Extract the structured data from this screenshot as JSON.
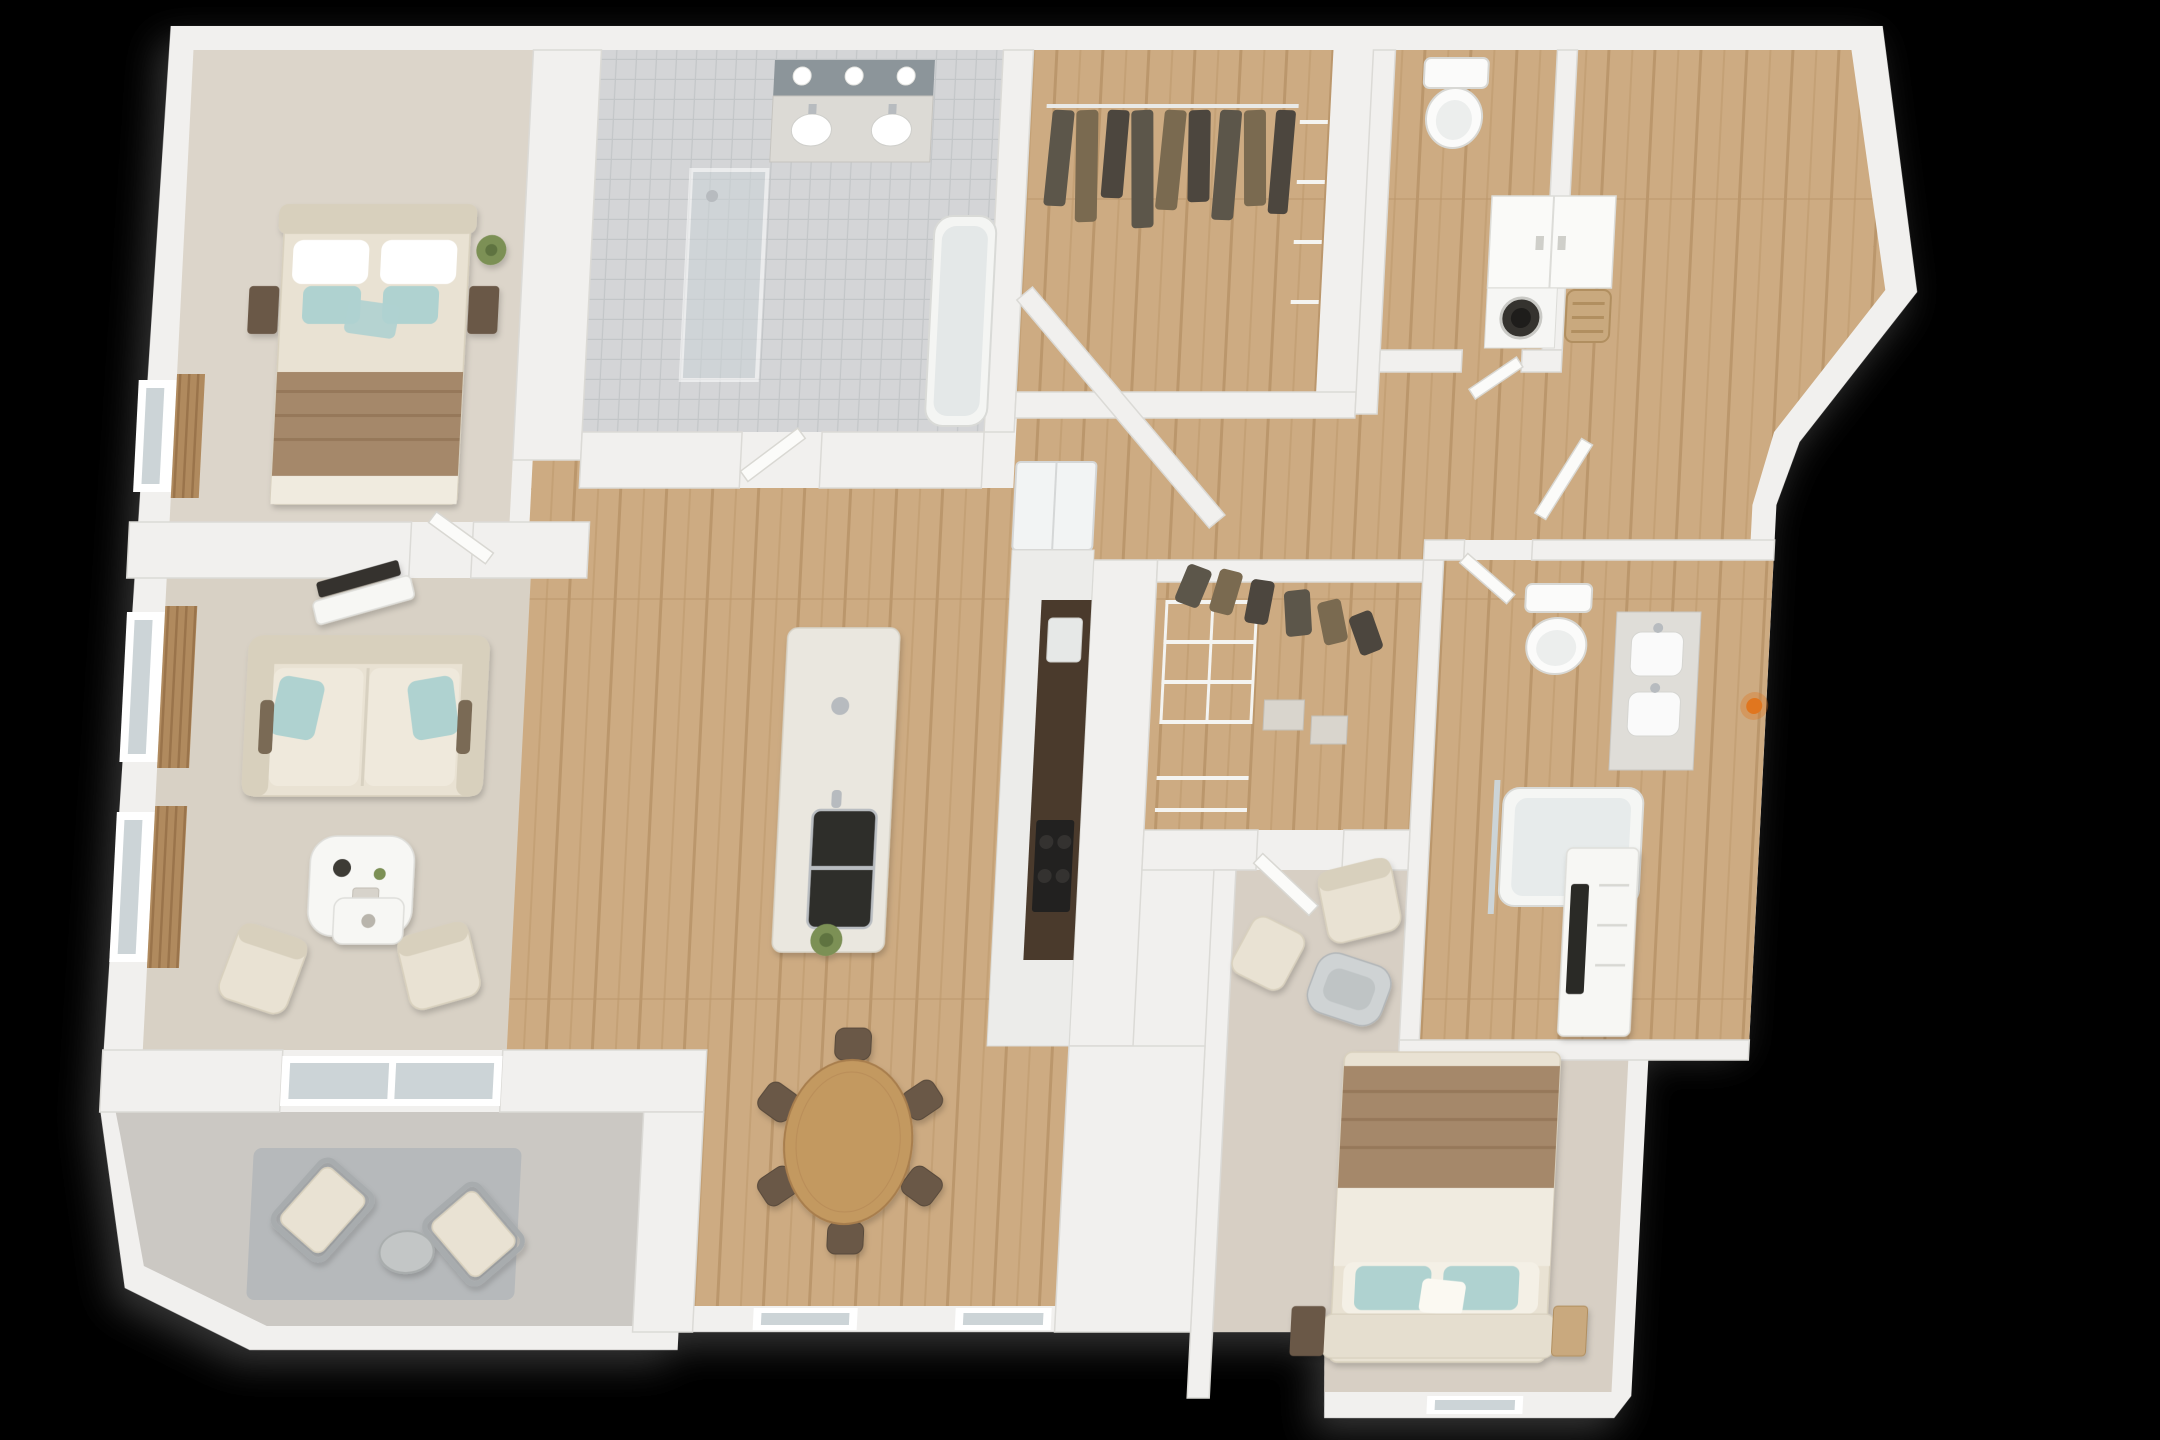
{
  "scene": {
    "description": "3D rendered top-down dollhouse floor plan of a two-bedroom two-bath apartment on a black background",
    "render_style": "3d-floor-plan-render",
    "visible_text": ""
  },
  "palette": {
    "bg": "#000000",
    "wall": "#f1f0ee",
    "wallEdge": "#dbdad6",
    "wood": "#cdab82",
    "woodDark": "#bb976c",
    "woodMid": "#c4a176",
    "tile": "#d4d5d7",
    "tileLine": "#c3c6c8",
    "carpet1": "#dcd5ca",
    "carpet2": "#d7cfc4",
    "rugLiving": "#d8d1c5",
    "rugPatio": "#b6b9bb",
    "patioFloor": "#cbc8c3",
    "cream": "#e9e2d3",
    "creamShade": "#d8d0bd",
    "teal": "#afd2d0",
    "blanket": "#a5886a",
    "darkwood": "#6b5847",
    "counter": "#4a3a2c",
    "appliance": "#222120",
    "olive": "#5c564a",
    "brown2": "#7a6a50",
    "plant": "#7b9055",
    "chrome": "#b7bbbf",
    "glass": "#ccd4d7",
    "mirror": "#8c959a",
    "tableWood": "#c39960",
    "orange": "#e0761f",
    "curtainA": "#b08a5e",
    "curtainB": "#9a744b"
  },
  "apartment": {
    "rooms": [
      {
        "id": "bedroom-1",
        "furniture": [
          "double-bed",
          "teal-pillows",
          "brown-throw-blanket",
          "nightstand-left",
          "nightstand-right",
          "plant",
          "window-with-curtain"
        ]
      },
      {
        "id": "living-room",
        "furniture": [
          "sofa",
          "teal-throw-pillows",
          "coffee-table",
          "tv-console",
          "armchair-left",
          "armchair-right",
          "side-table",
          "curtained-window-upper",
          "curtained-window-lower",
          "area-rug"
        ]
      },
      {
        "id": "patio",
        "furniture": [
          "lounge-chair-left",
          "lounge-chair-right",
          "outdoor-side-table",
          "outdoor-rug",
          "sliding-glass-door"
        ]
      },
      {
        "id": "dining-area",
        "furniture": [
          "round-wood-table",
          "dining-chairs-x6",
          "window-left",
          "window-right"
        ]
      },
      {
        "id": "kitchen",
        "furniture": [
          "island-with-sink-and-faucet",
          "island-plant",
          "refrigerator",
          "cabinet-run",
          "dark-counter-bar",
          "cooktop"
        ]
      },
      {
        "id": "bathroom-1",
        "furniture": [
          "double-vanity",
          "mirror-with-three-lights",
          "walk-in-shower",
          "bathtub"
        ]
      },
      {
        "id": "walk-in-closet-1",
        "furniture": [
          "clothes-rod",
          "hanging-clothes",
          "side-shelves"
        ]
      },
      {
        "id": "hallway",
        "furniture": [
          "angled-wall"
        ]
      },
      {
        "id": "wc",
        "furniture": [
          "toilet"
        ]
      },
      {
        "id": "laundry-room",
        "furniture": [
          "upper-cabinet",
          "front-load-washer",
          "laundry-basket"
        ]
      },
      {
        "id": "walk-in-closet-2",
        "furniture": [
          "wire-shelving",
          "hanging-clothes",
          "storage-boxes"
        ]
      },
      {
        "id": "bathroom-2",
        "furniture": [
          "toilet",
          "double-sink-vanity",
          "bathtub-with-glass",
          "orange-candle"
        ]
      },
      {
        "id": "bedroom-2",
        "furniture": [
          "double-bed",
          "teal-pillows",
          "brown-throw-blanket",
          "nightstand-left",
          "wicker-basket",
          "dresser-with-tv",
          "armchair",
          "ottoman",
          "lounge-chair",
          "window"
        ]
      }
    ]
  }
}
